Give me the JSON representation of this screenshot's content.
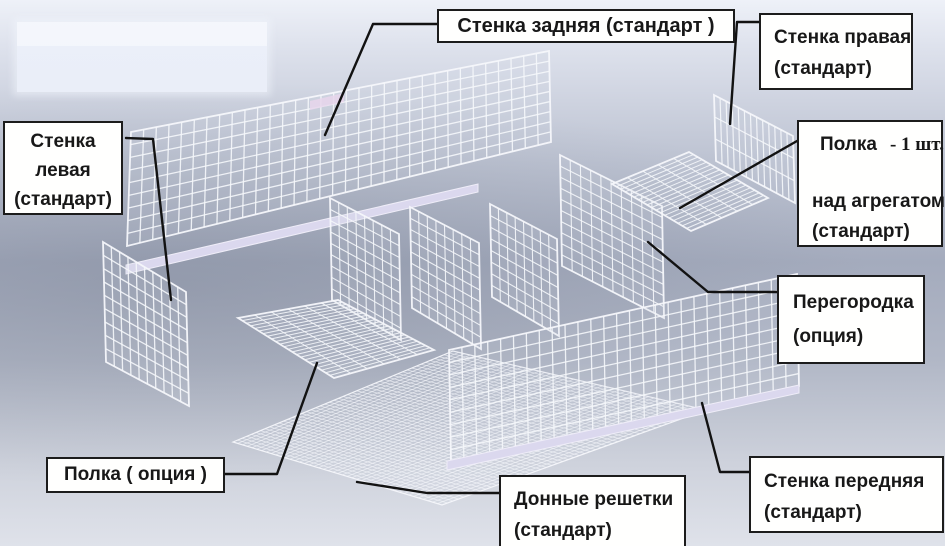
{
  "colors": {
    "leader_line": "#121212",
    "box_border": "#1c1c1c",
    "box_background": "#fffffe",
    "wire": "#f5f7fb",
    "rail": "#dbd8ee",
    "pink_patch": "#e7d6ec"
  },
  "labels": {
    "back_wall": {
      "text": "Стенка задняя (стандарт )"
    },
    "right_wall": {
      "line1": "Стенка правая",
      "line2": "(стандарт)"
    },
    "shelf_over_unit": {
      "line1_main": "Полка",
      "line1_qty": "- 1 шт.",
      "line2": "над агрегатом",
      "line3": "(стандарт)"
    },
    "left_wall": {
      "line1": "Стенка",
      "line2": "левая",
      "line3": "(стандарт)"
    },
    "partition": {
      "line1": "Перегородка",
      "line2": "(опция)"
    },
    "shelf_option": {
      "text": "Полка ( опция )"
    },
    "bottom_grids": {
      "line1": "Донные решетки",
      "line2": "(стандарт)"
    },
    "front_wall": {
      "line1": "Стенка передняя",
      "line2": "(стандарт)"
    }
  }
}
